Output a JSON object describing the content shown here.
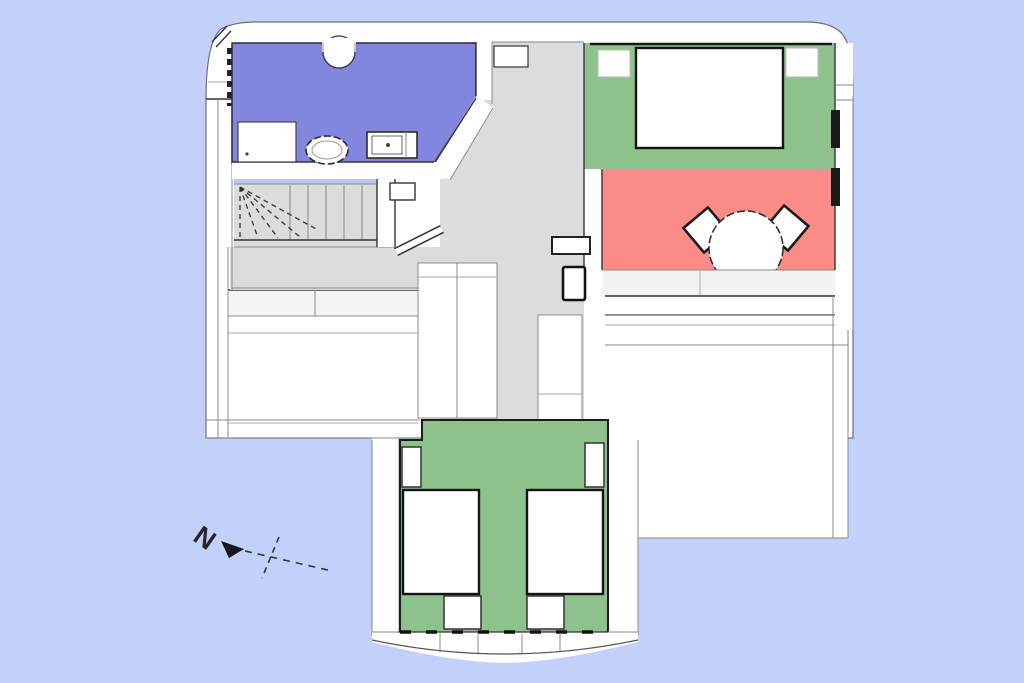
{
  "compass": {
    "north_label": "N"
  },
  "palette": {
    "background": "#c3d1fa",
    "wall_fill": "#ffffff",
    "bathroom_floor": "#8386df",
    "bedroom_floor": "#8ec28c",
    "terrace_floor": "#fb8b86",
    "hallway_floor": "#dcdcdc",
    "stair_opening_strip": "#b9c7f0",
    "window_glass": "#1a1a1a",
    "outline": "#333333"
  }
}
